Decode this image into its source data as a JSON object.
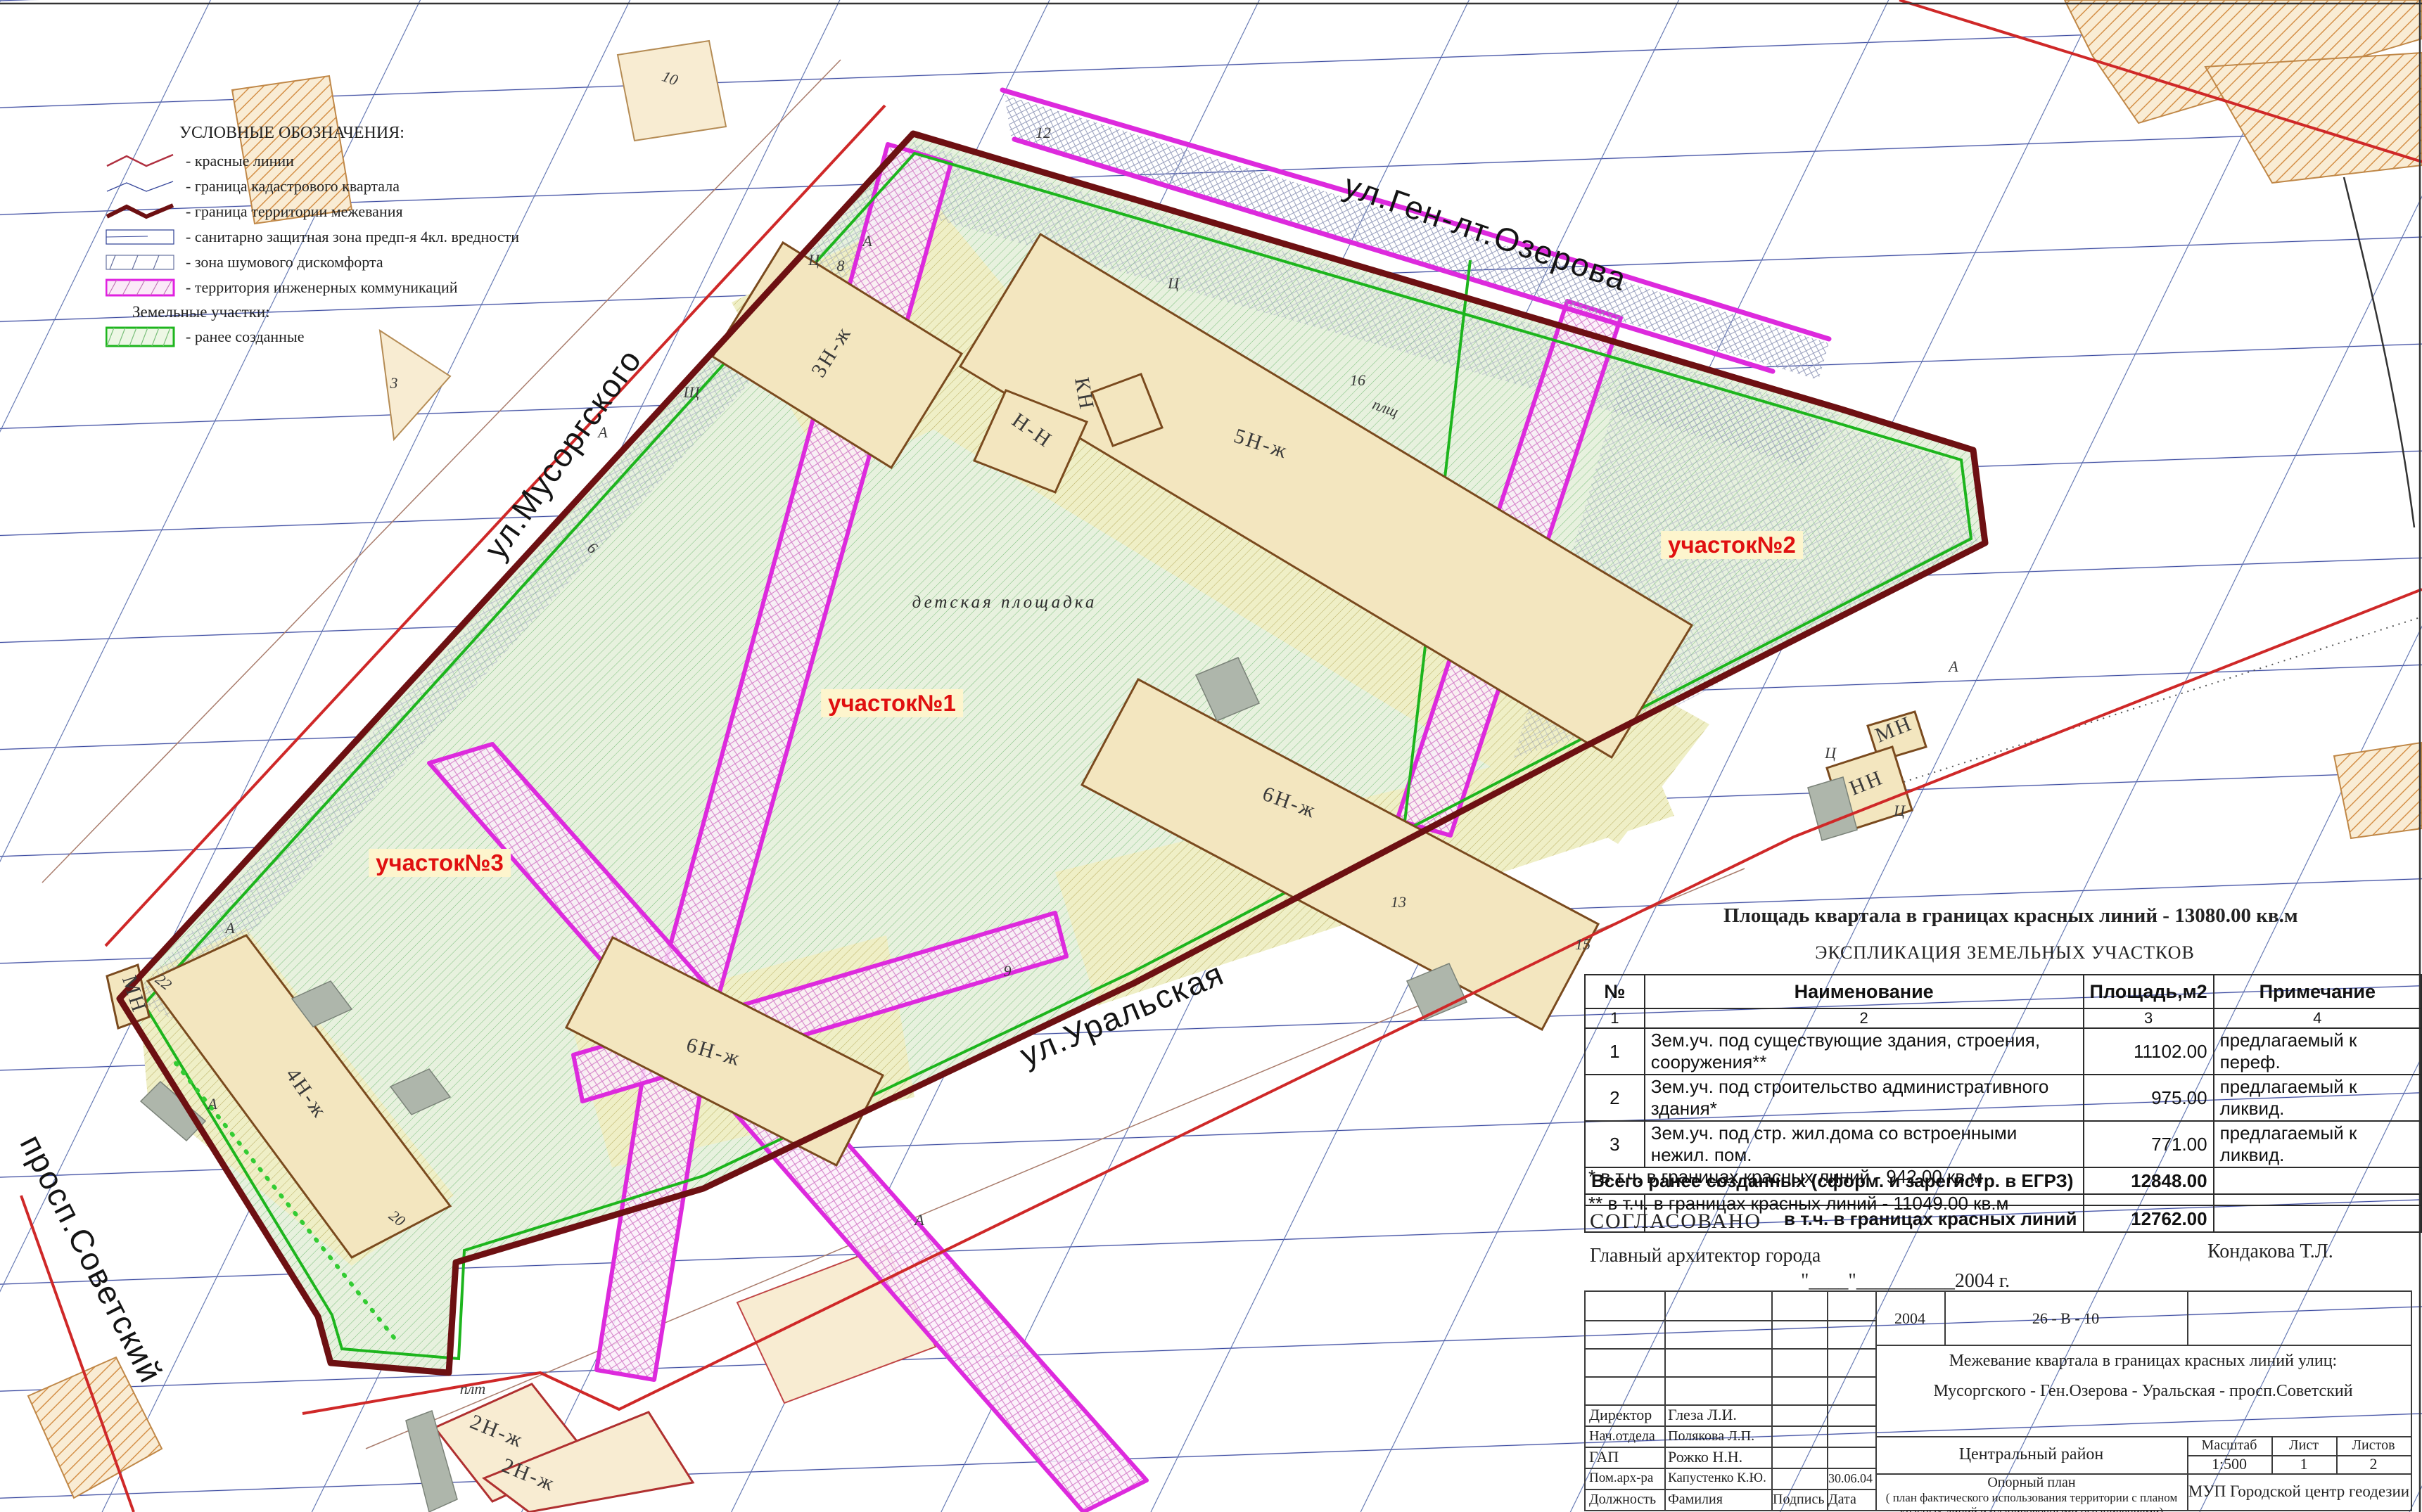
{
  "legend": {
    "title": "УСЛОВНЫЕ ОБОЗНАЧЕНИЯ:",
    "items": [
      "- красные линии",
      "- граница кадастрового квартала",
      "- граница территории межевания",
      "- санитарно защитная зона предп-я 4кл. вредности",
      "- зона шумового дискомфорта",
      "- территория инженерных коммуникаций"
    ],
    "subtitle": "Земельные участки:",
    "sub_item": "- ранее созданные"
  },
  "streets": {
    "ozerova": "ул.Ген-лт.Озерова",
    "musorgskogo": "ул.Мусоргского",
    "uralskaya": "ул.Уральская",
    "sovetsky": "просп.Советский"
  },
  "parcels": {
    "p1": "участок№1",
    "p2": "участок№2",
    "p3": "участок№3"
  },
  "map_texts": {
    "playground": "детская площадка",
    "buildings": {
      "b3": "3Н-ж",
      "b5": "5Н-ж",
      "b6r": "6Н-ж",
      "b6c": "6Н-ж",
      "b4": "4Н-ж",
      "b2a": "2Н-ж",
      "b2b": "2Н-ж",
      "nn": "Н-Н",
      "kn": "КН",
      "mn_left": "МН",
      "mn_right": "МН",
      "nn_right": "НН",
      "plsch": "плщ",
      "plt": "плт"
    },
    "letters": [
      "А",
      "А",
      "А",
      "А",
      "А",
      "А",
      "Ц",
      "Ц",
      "Ц",
      "Ц",
      "Щ",
      "8",
      "16",
      "15",
      "13",
      "9",
      "6",
      "22",
      "20",
      "10",
      "3",
      "12"
    ]
  },
  "area_note": {
    "title": "Площадь квартала в границах красных линий  - 13080.00 кв.м",
    "subtitle": "ЭКСПЛИКАЦИЯ ЗЕМЕЛЬНЫХ УЧАСТКОВ"
  },
  "table": {
    "headers": [
      "№",
      "Наименование",
      "Площадь,м2",
      "Примечание"
    ],
    "col_numbers": [
      "1",
      "2",
      "3",
      "4"
    ],
    "rows": [
      {
        "num": "1",
        "name": "Зем.уч. под существующие здания, строения, сооружения**",
        "area": "11102.00",
        "note": "предлагаемый к переф."
      },
      {
        "num": "2",
        "name": "Зем.уч. под строительство административного здания*",
        "area": "975.00",
        "note": "предлагаемый к ликвид."
      },
      {
        "num": "3",
        "name": "Зем.уч. под стр.  жил.дома со встроенными нежил. пом.",
        "area": "771.00",
        "note": "предлагаемый к ликвид."
      }
    ],
    "total_label": "Всего ранее созданных (сформ. и зарегистр. в ЕГРЗ)",
    "total_value": "12848.00",
    "subtotal_label": "в т.ч. в границах красных линий",
    "subtotal_value": "12762.00",
    "footnote1": "* в т.ч. в границах красных линий - 942.00 кв.м",
    "footnote2": "** в т.ч. в границах красных линий - 11049.00 кв.м"
  },
  "approval": {
    "agreed": "СОГЛАСОВАНО",
    "role": "Главный архитектор города",
    "name": "Кондакова Т.Л.",
    "date_line": "\"____\"__________2004 г."
  },
  "title_block": {
    "year": "2004",
    "code": "26 - В - 10",
    "subject1": "Межевание квартала в границах красных линий улиц:",
    "subject2": "Мусоргского - Ген.Озерова - Уральская - просп.Советский",
    "district": "Центральный район",
    "scale_label": "Масштаб",
    "scale": "1:500",
    "sheet_label": "Лист",
    "sheet": "1",
    "sheets_label": "Листов",
    "sheets": "2",
    "plan_title": "Опорный план",
    "plan_subtitle": "( план фактического использования территории с планом красных линий и планировочными ограничениями)",
    "org": "МУП Городской центр геодезии",
    "roles": [
      {
        "role": "Директор",
        "name": "Глеза Л.И.",
        "date": ""
      },
      {
        "role": "Нач.отдела",
        "name": "Полякова Л.П.",
        "date": ""
      },
      {
        "role": "ГАП",
        "name": "Рожко Н.Н.",
        "date": ""
      },
      {
        "role": "Пом.арх-ра",
        "name": "Капустенко К.Ю.",
        "date": "30.06.04"
      }
    ],
    "footer": [
      "Должность",
      "Фамилия",
      "Подпись",
      "Дата"
    ]
  },
  "colors": {
    "boundary_dark_red": "#6d1012",
    "red_line": "#cf2828",
    "grid_blue": "#3b4aa0",
    "grid_light_blue": "#5a6fae",
    "magenta": "#dd2add",
    "green_line": "#1db51d",
    "green_hatch": "#7cc07c",
    "parcel_base": "#e7f1de",
    "yellow_base": "#efefc6",
    "yellow_hatch": "#b9ae62",
    "building_fill": "#f3e6bf",
    "building_stroke": "#7a4a1e",
    "tan_fill": "#f8ecd2",
    "orange_hatch": "#d49048",
    "label_red": "#e01010",
    "label_bg": "#fdf5cd",
    "grey_cross": "#8b93b5",
    "pink_cross": "#d47ec8",
    "annex_grey": "#aeb6ab"
  }
}
